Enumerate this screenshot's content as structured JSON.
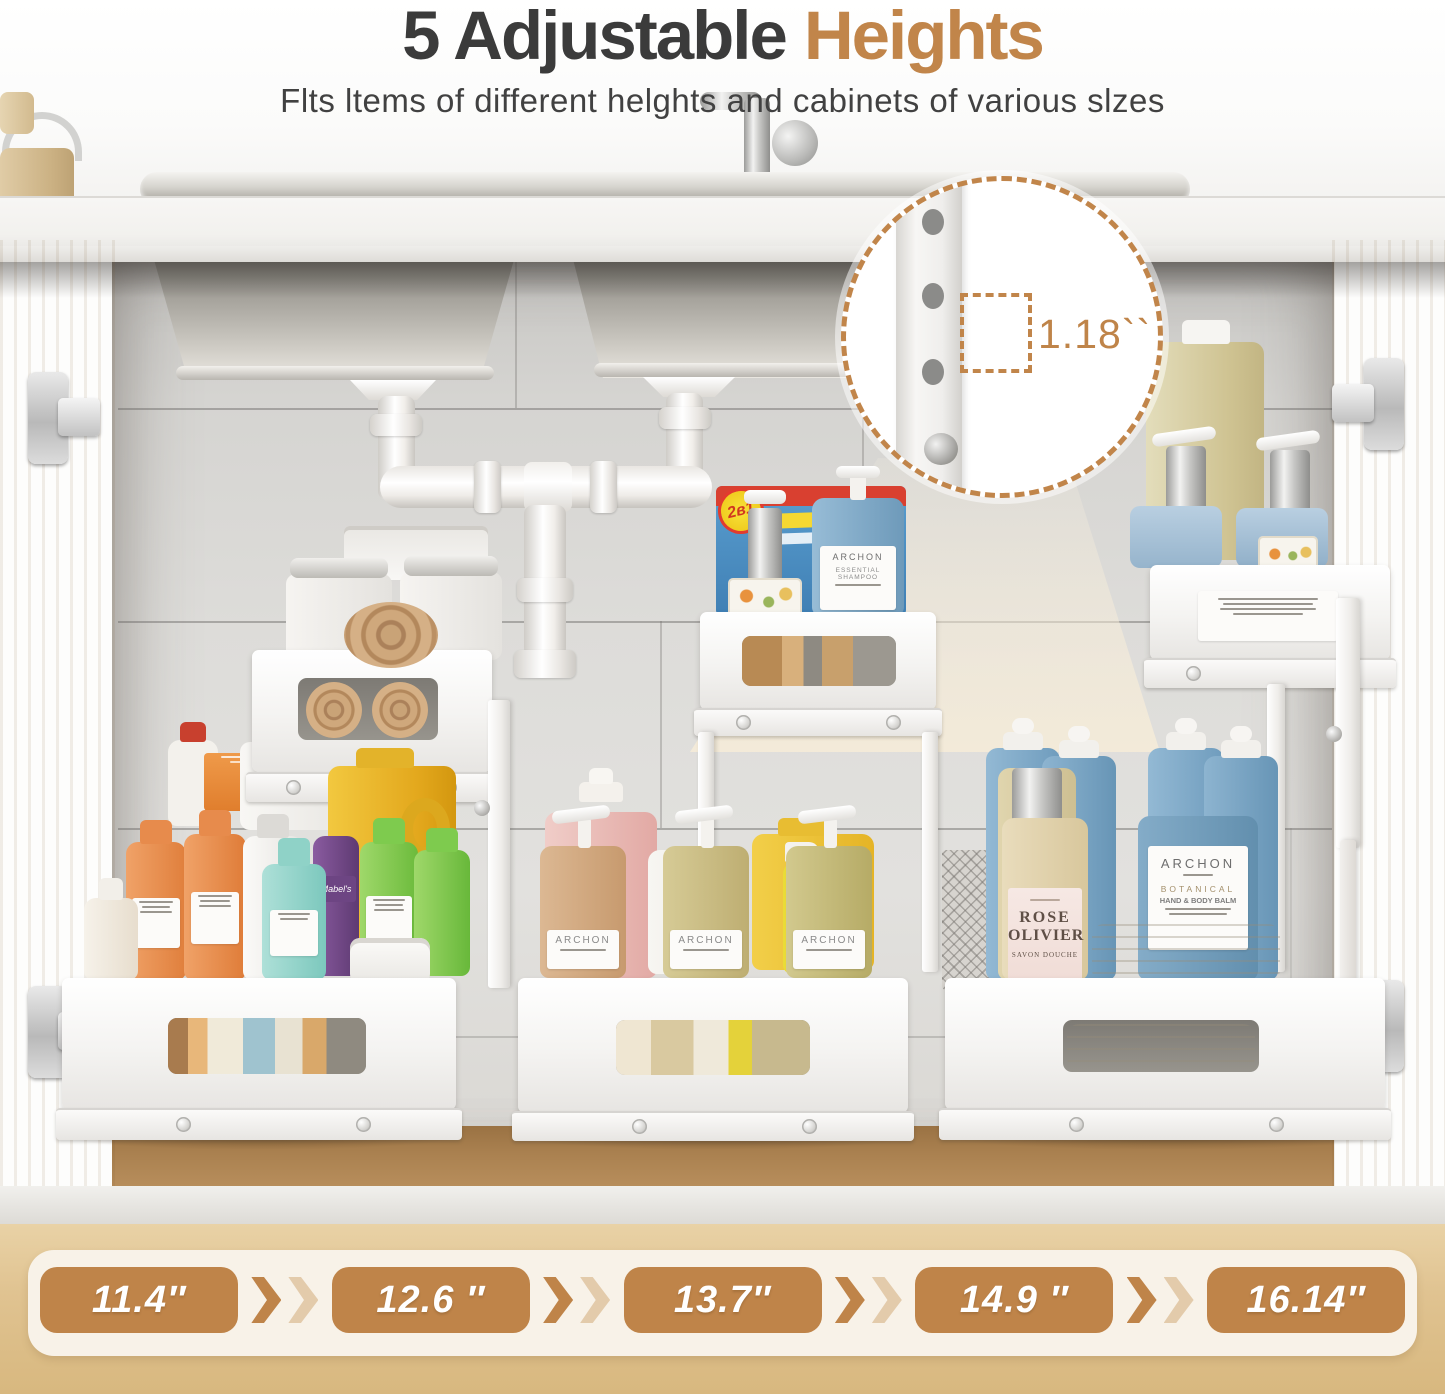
{
  "header": {
    "title_main": "5 Adjustable",
    "title_accent": "Heights",
    "subtitle": "Flts ltems of different helghts and cabinets of various slzes"
  },
  "callout": {
    "measurement": "1.18``"
  },
  "heights": {
    "values": [
      "11.4″",
      "12.6 ″",
      "13.7″",
      "14.9 ″",
      "16.14″"
    ]
  },
  "products": {
    "brand": "ARCHON",
    "shampoo_line1": "ESSENTIAL",
    "shampoo_line2": "SHAMPOO",
    "balm_line1": "BOTANICAL",
    "balm_line2": "HAND & BODY BALM",
    "rose_line1": "ROSE",
    "rose_line2": "OLIVIER",
    "rose_sub": "SAVON DOUCHE",
    "detergent_badge": "2в1",
    "purple_label": "Mabel's"
  },
  "colors": {
    "accent": "#c1854a",
    "accent_light": "#e3cbab",
    "title_dark": "#3b3b3b",
    "band_bg": "#f8f2e8",
    "badge_bg": "#bf8449"
  }
}
